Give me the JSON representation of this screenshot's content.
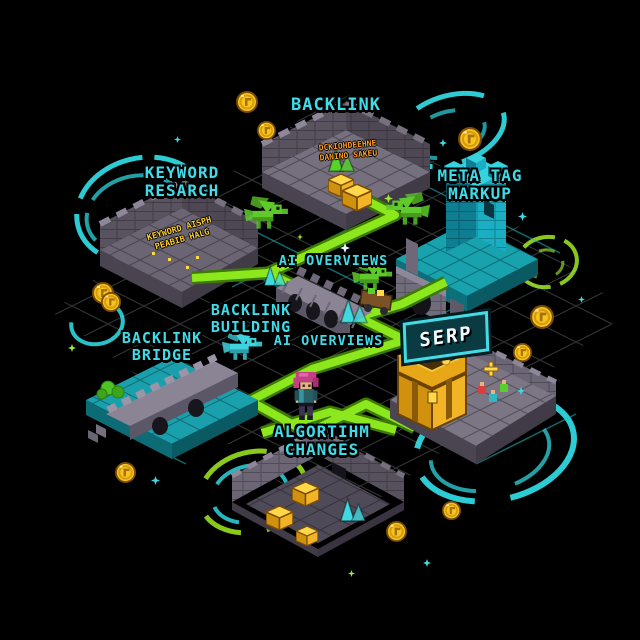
{
  "map": {
    "title_labels": {
      "backlink": "BACKLINK",
      "keyword": {
        "line1": "KEYWORD",
        "line2": "RESARCH"
      },
      "meta_tag": {
        "line1": "META TAG",
        "line2": "MARKUP"
      },
      "ai_overviews_top": "AI OVERVIEWS",
      "backlink_building": {
        "line1": "BACKLINK",
        "line2": "BUILDING"
      },
      "ai_overviews_bottom": "AI OVERVIEWS",
      "backlink_bridge": {
        "line1": "BACKLINK",
        "line2": "BRIDGE"
      },
      "serp_sign": "SERP",
      "algorithm_changes": {
        "line1": "ALGORTIHM",
        "line2": "CHANGES"
      }
    },
    "wall_inscriptions": {
      "backlink_ruin": {
        "line1": "DCKIOHDEEHNE",
        "line2": "DANINO SAKEU"
      },
      "keyword_ruin": {
        "line1": "KEYWORD AISPH",
        "line2": "PEABIB HALG"
      }
    },
    "colors": {
      "background": "#000000",
      "path_green": "#8ce71c",
      "path_green_dark": "#3c7a02",
      "label_cyan": "#3fdbe8",
      "platform_teal": "#17a2ae",
      "stone_gray": "#7b7584",
      "gold": "#f2b424",
      "portal_cyan": "#2fd6de",
      "portal_green": "#8fd41e"
    },
    "icons": [
      "coin-icon",
      "sparkle-icon",
      "portal-swirl-icon",
      "dragon-icon",
      "crystal-icon",
      "gold-block-icon",
      "treasure-chest-icon",
      "hero-character-icon"
    ]
  }
}
